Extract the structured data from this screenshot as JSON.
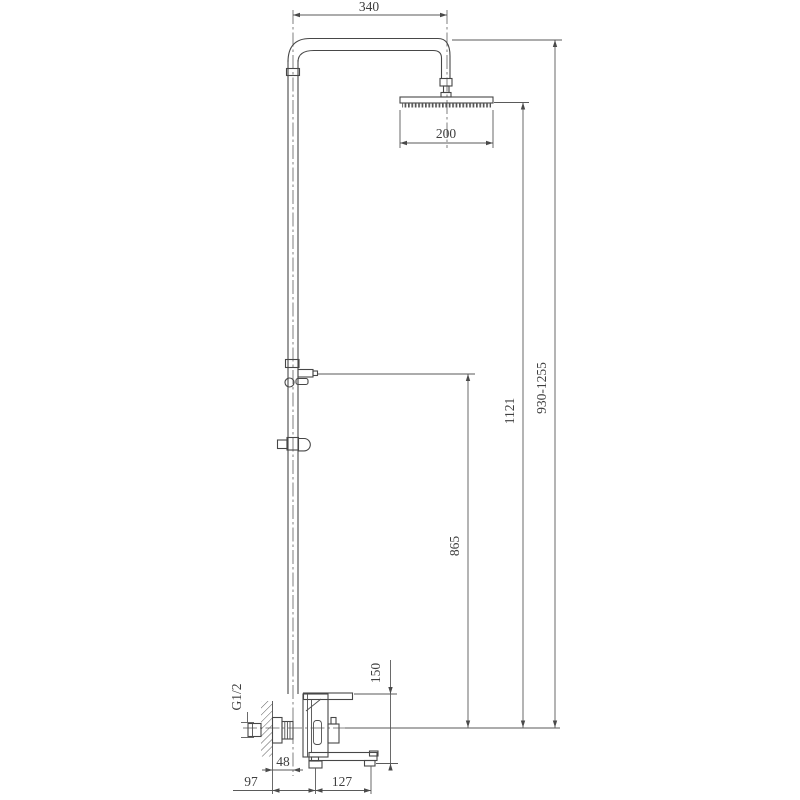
{
  "drawing": {
    "type": "shower-system-installation-dimensions",
    "units_implied": "mm",
    "dims": {
      "arm_reach": "340",
      "head_size": "200",
      "head_height": "1121",
      "total_height": "930-1255",
      "outlet_height": "865",
      "body_height": "150",
      "wall_offset": "48",
      "wall_to_port": "97",
      "spout_reach": "127",
      "inlet_thread": "G1/2"
    },
    "line_color": "#474747",
    "background": "#ffffff"
  }
}
